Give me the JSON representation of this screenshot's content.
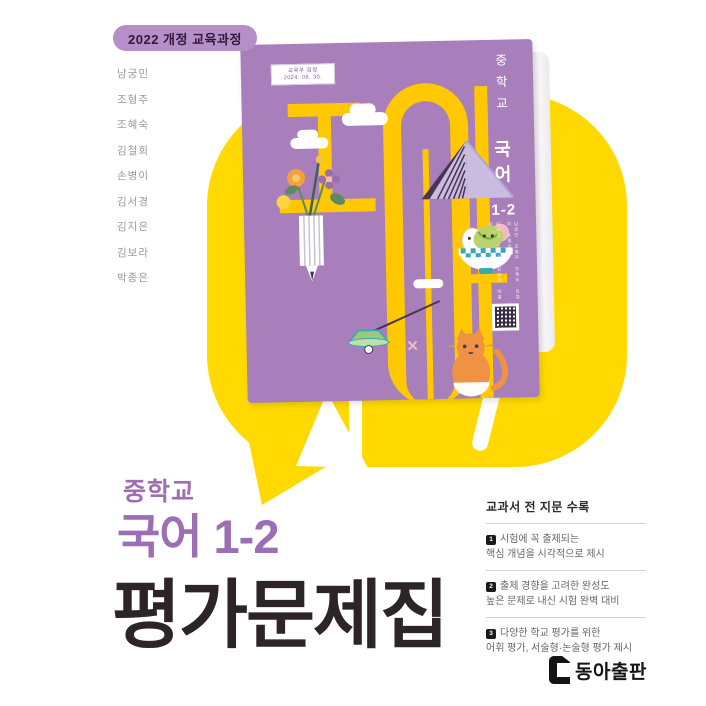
{
  "badge": {
    "label": "2022 개정 교육과정"
  },
  "authors": [
    "남궁민",
    "조형주",
    "조혜숙",
    "김철회",
    "손병이",
    "김서경",
    "김지은",
    "김보라",
    "박종은"
  ],
  "cover": {
    "cert_line1": "교육부 검정",
    "cert_line2": "2024. 08. 30.",
    "school": "중학교",
    "subject": "국어",
    "grade": "1-2",
    "authors_col1": "남궁민 조형주 조혜숙 김철회 손병이",
    "authors_col2": "김서경 김지은 김보라 박종은"
  },
  "title": {
    "school": "중학교",
    "subject_grade": "국어 1-2",
    "main": "평가문제집"
  },
  "features": {
    "header": "교과서 전 지문 수록",
    "items": [
      {
        "num": "1",
        "line1": "시험에 꼭 출제되는",
        "line2": "핵심 개념을 시각적으로 제시"
      },
      {
        "num": "2",
        "line1": "출제 경향을 고려한 완성도",
        "line2": "높은 문제로 내신 시험 완벽 대비"
      },
      {
        "num": "3",
        "line1": "다양한 학교 평가를 위한",
        "line2": "어휘 평가, 서술형·논술형 평가 제시"
      }
    ]
  },
  "publisher": {
    "name": "동아출판"
  },
  "colors": {
    "bubble_yellow": "#ffd900",
    "cover_purple": "#a87fba",
    "cover_art_yellow": "#ffc800",
    "accent_purple": "#9c6eb3",
    "title_dark": "#2c2426",
    "badge_bg": "#b78fc8"
  }
}
